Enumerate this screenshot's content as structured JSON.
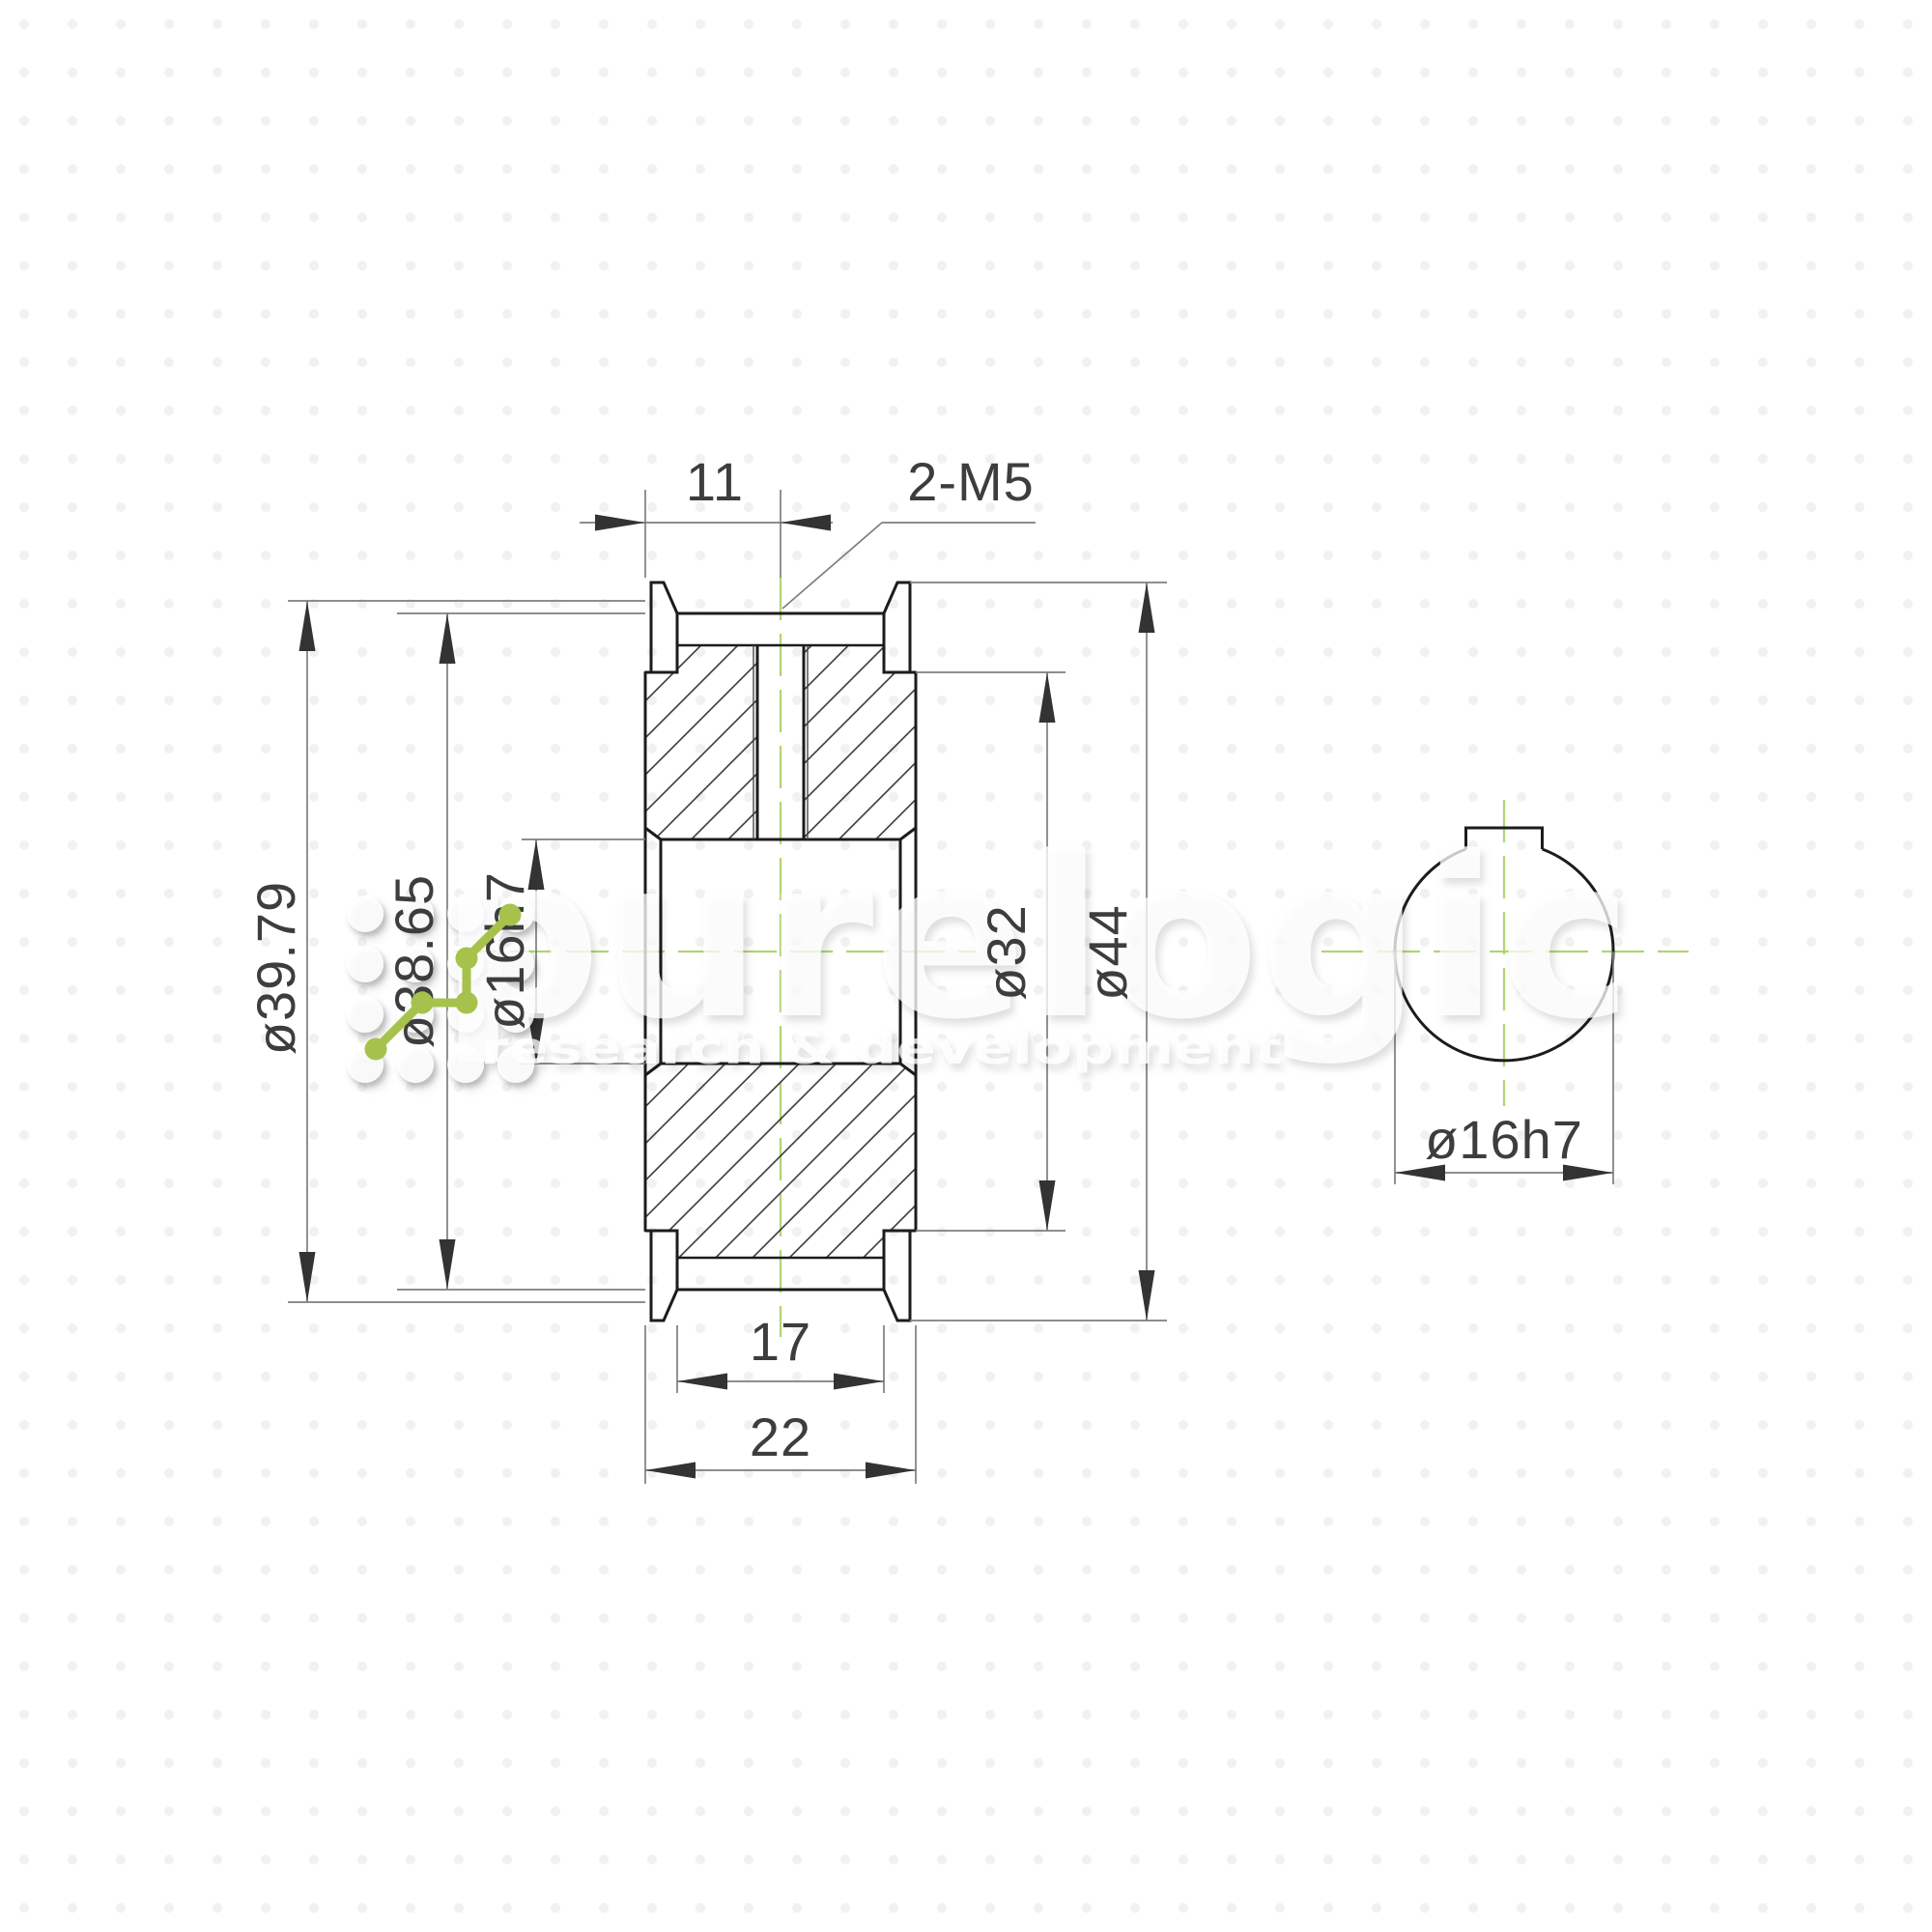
{
  "title": "Timing pulley dimensional drawing",
  "dimensions": {
    "face_to_hole_width": "11",
    "set_screw_thread": "2-M5",
    "pitch_diameter": "ø39.79",
    "outside_diameter": "ø38.65",
    "bore_diameter": "ø16h7",
    "hub_step_diameter": "ø32",
    "flange_diameter": "ø44",
    "belt_width": "17",
    "overall_width": "22",
    "end_view_bore_diameter": "ø16h7"
  },
  "watermark": {
    "brand": "purelogic",
    "tagline": "research & development"
  },
  "colors": {
    "accent_green": "#a6c24c",
    "centerline_green": "#b2d473",
    "outline_dark": "#1c1c1c",
    "dimension_gray": "#7e7e7e",
    "text_dark": "#3d3d3d"
  }
}
